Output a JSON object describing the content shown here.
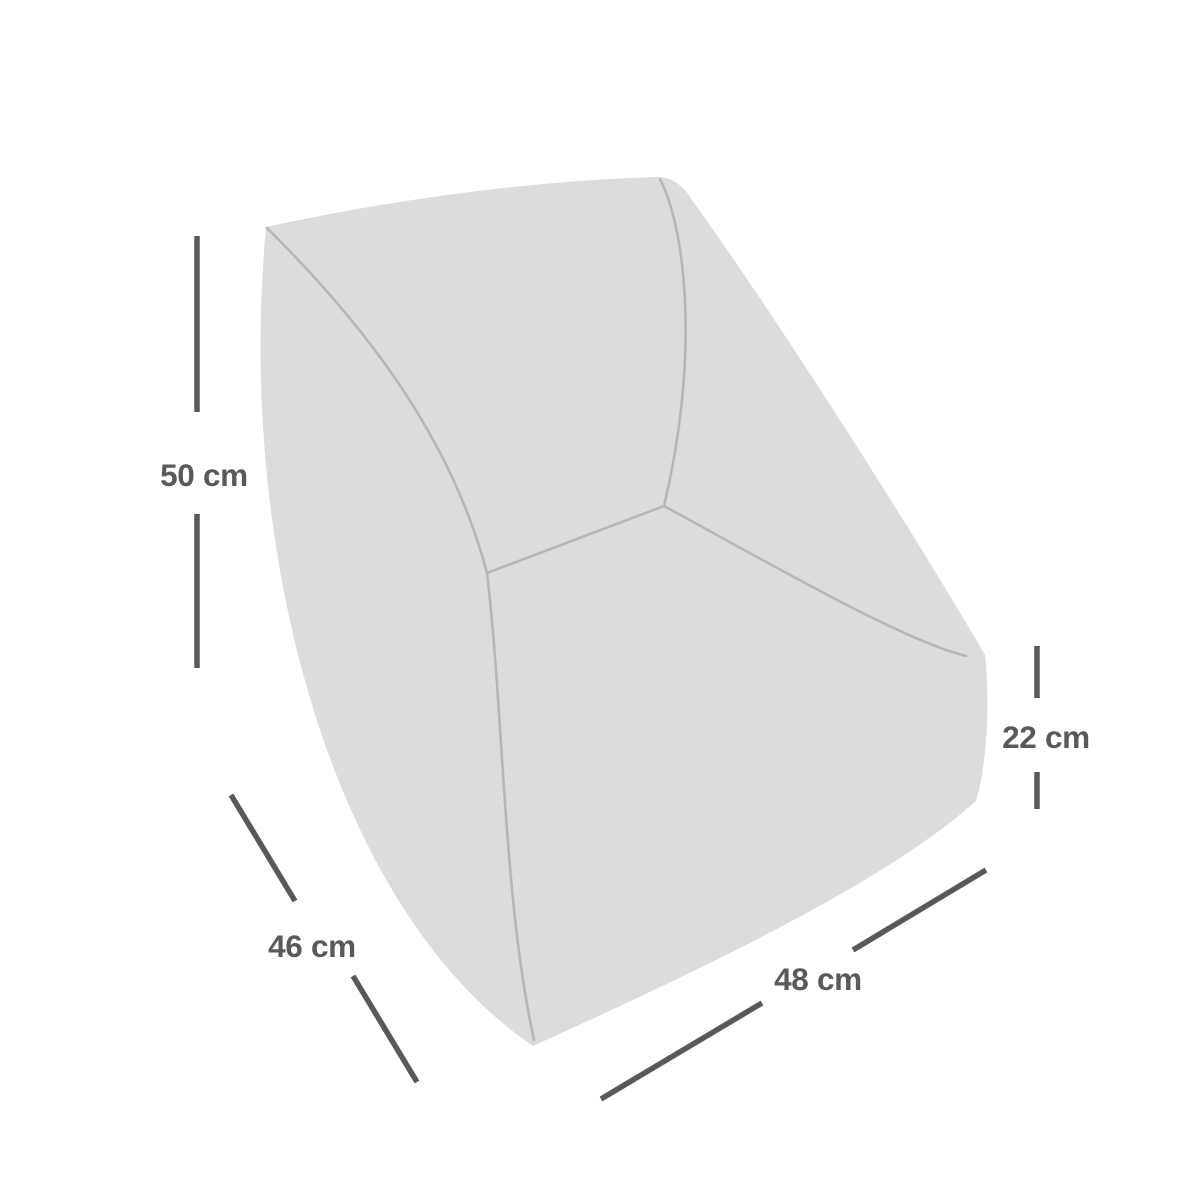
{
  "page": {
    "background_color": "#ffffff",
    "description": "Product dimension diagram of a rounded armless lounge chair shown in three-quarter back view"
  },
  "diagram": {
    "shape_fill_color": "#dbdcdd",
    "crease_line_color": "#b5b6b8",
    "dimension_line_color": "#58595b",
    "unit": "cm",
    "dimensions": [
      {
        "id": "back-height",
        "label": "50 cm",
        "value": 50,
        "placement": "left-vertical"
      },
      {
        "id": "side-depth",
        "label": "46 cm",
        "value": 46,
        "placement": "bottom-left-diagonal"
      },
      {
        "id": "front-width",
        "label": "48 cm",
        "value": 48,
        "placement": "bottom-right-diagonal"
      },
      {
        "id": "base-height",
        "label": "22 cm",
        "value": 22,
        "placement": "right-vertical"
      }
    ]
  }
}
